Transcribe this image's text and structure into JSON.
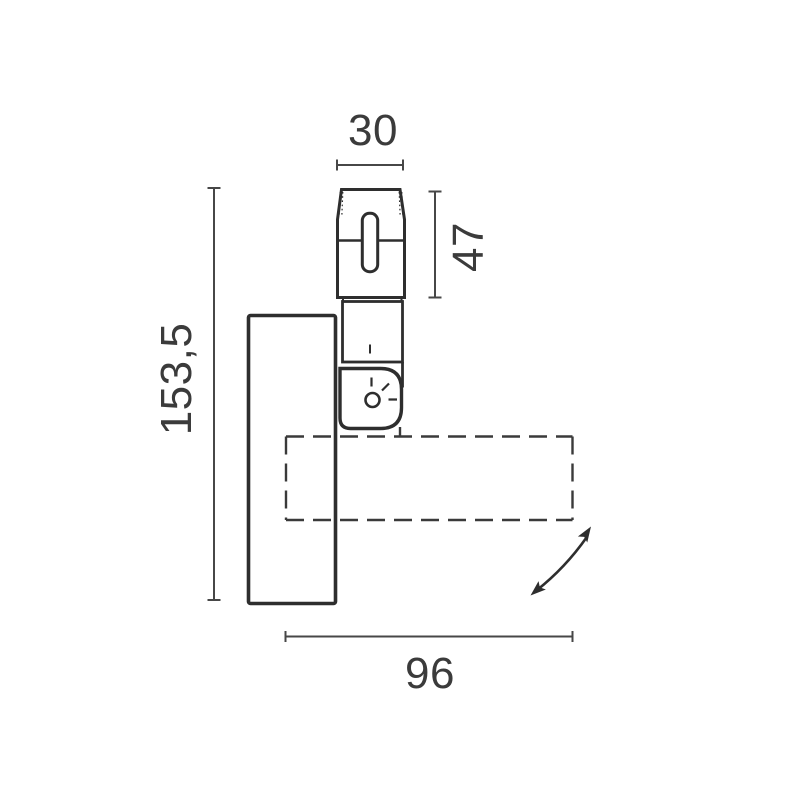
{
  "diagram": {
    "type": "technical-dimension-drawing",
    "subject": "window-handle-side-view-with-rotation",
    "colors": {
      "background": "#ffffff",
      "part_outline": "#2e2e2e",
      "dimension_line": "#474747",
      "text": "#3b3b3b"
    },
    "dimensions": [
      {
        "id": "housing-width",
        "label": "30",
        "orientation": "horizontal",
        "position": "top"
      },
      {
        "id": "housing-height",
        "label": "47",
        "orientation": "vertical",
        "position": "right"
      },
      {
        "id": "total-height",
        "label": "153,5",
        "orientation": "vertical",
        "position": "left"
      },
      {
        "id": "handle-length",
        "label": "96",
        "orientation": "horizontal",
        "position": "bottom"
      }
    ],
    "annotations": [
      {
        "id": "rotation-arrow",
        "type": "curved-double-headed-arrow",
        "meaning": "handle rotates 90 degrees"
      },
      {
        "id": "dashed-outline",
        "type": "phantom-line-rectangle",
        "meaning": "handle grip in horizontal position"
      }
    ]
  }
}
